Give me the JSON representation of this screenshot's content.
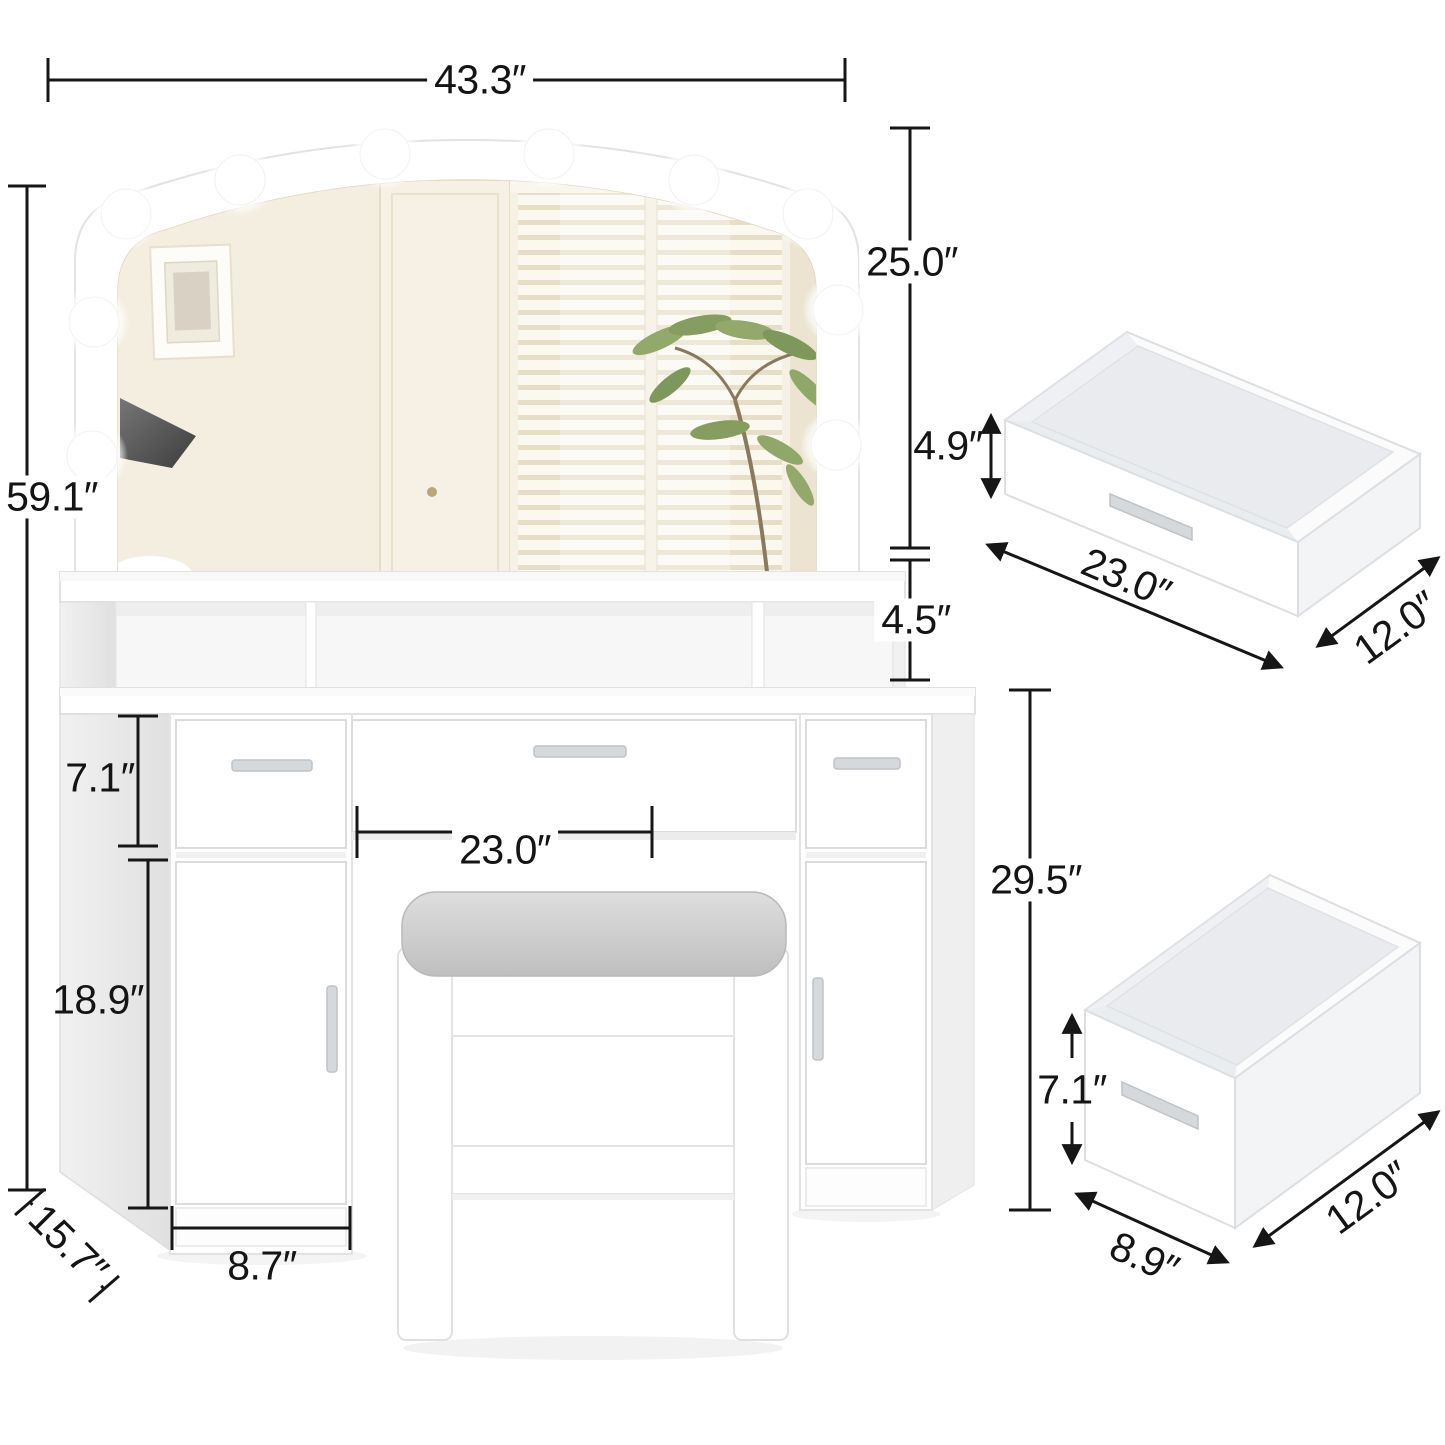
{
  "dimensions": {
    "vanity": {
      "top_width": "43.3″",
      "overall_height": "59.1″",
      "mirror_height": "25.0″",
      "shelf_height": "4.5″",
      "tabletop_height": "29.5″",
      "drawer_height": "7.1″",
      "cabinet_height": "18.9″",
      "cabinet_width": "8.7″",
      "depth": "15.7″",
      "knee_space_width": "23.0″"
    },
    "wide_drawer": {
      "height": "4.9″",
      "width": "23.0″",
      "depth": "12.0″"
    },
    "deep_drawer": {
      "height": "7.1″",
      "width": "8.9″",
      "depth": "12.0″"
    }
  },
  "colors": {
    "background": "#ffffff",
    "dimension_line": "#161616",
    "furniture": "#ffffff",
    "furniture_shadow": "#ededed",
    "cushion_gray": "#c9c9c9",
    "mirror_reflection_beige": "#f1ead9",
    "plant_green": "#8fa768",
    "handle_silver": "#d6d9dc"
  }
}
